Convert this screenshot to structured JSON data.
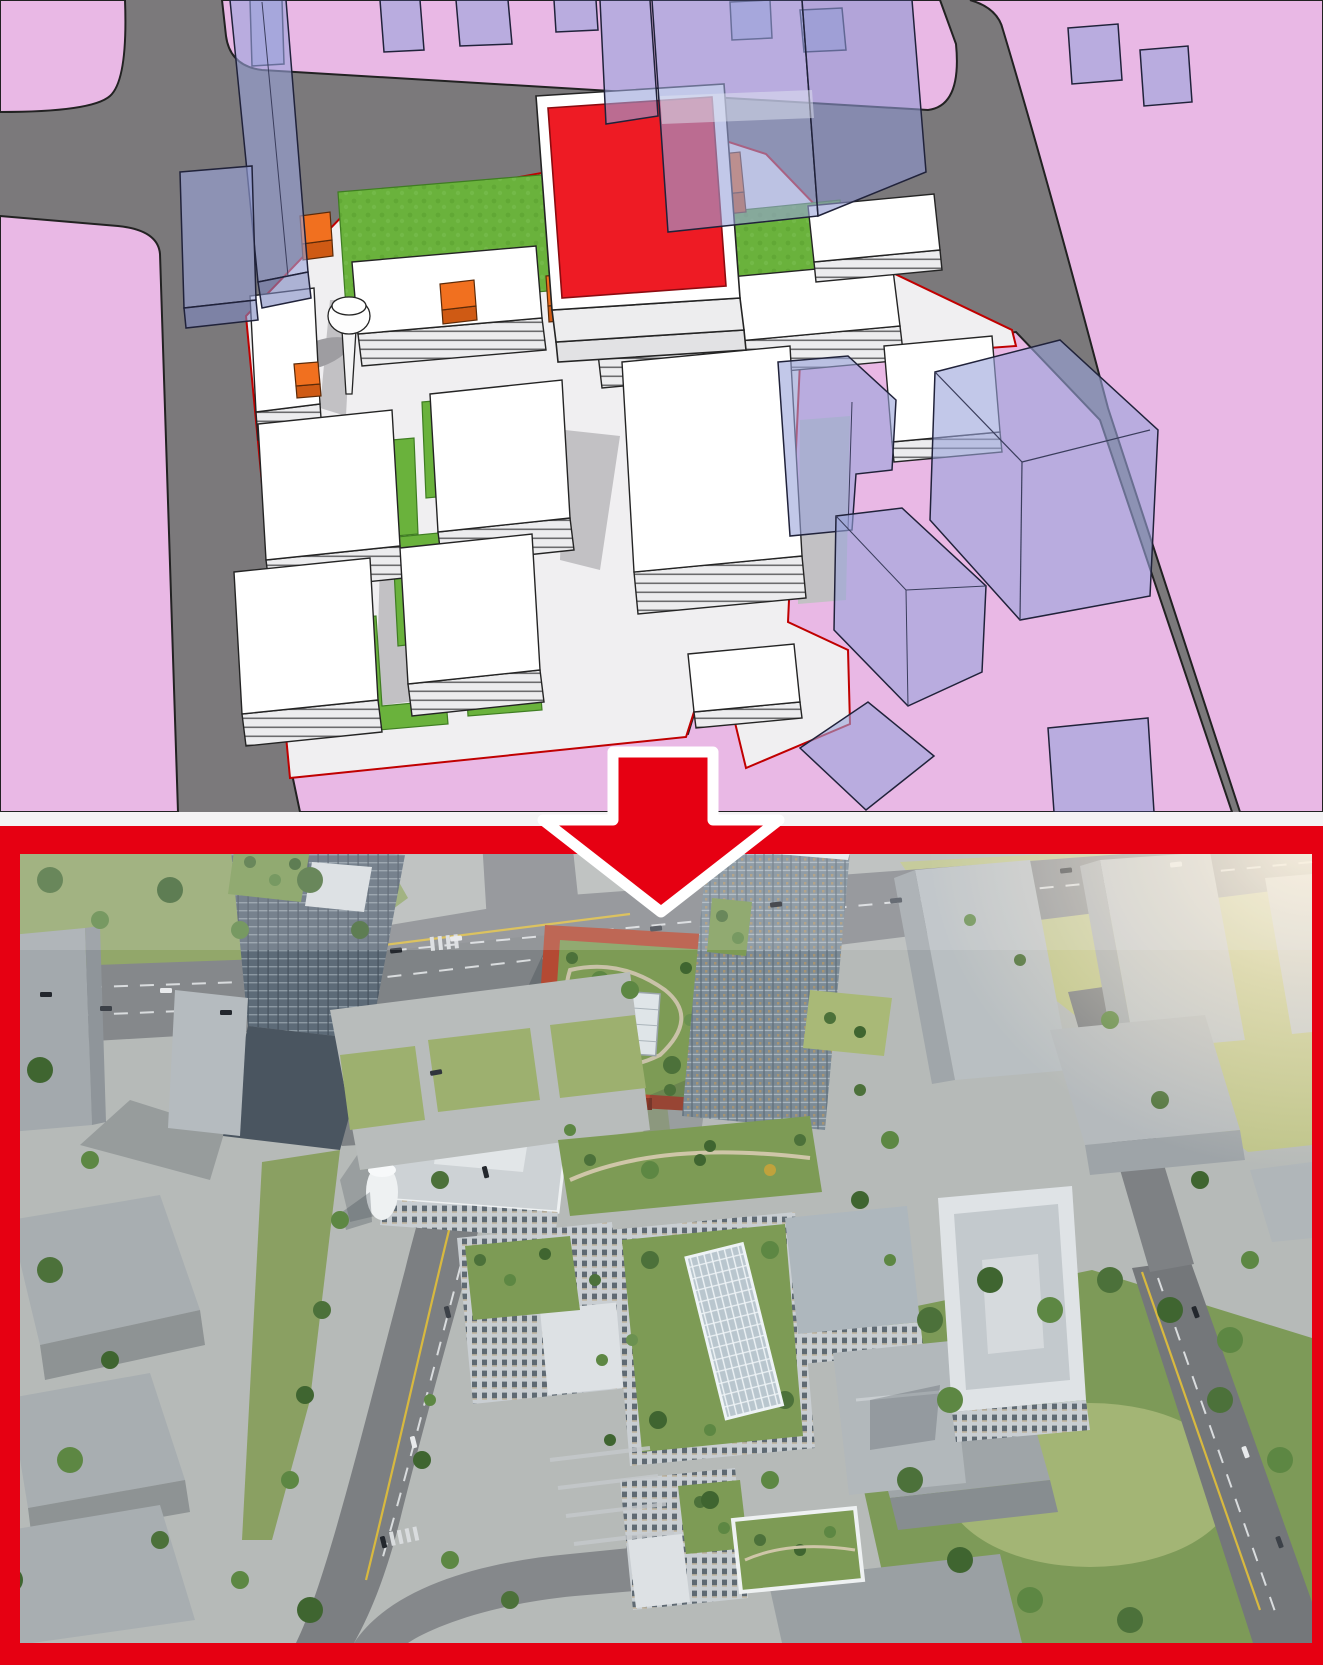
{
  "meta": {
    "description": "architectural before-after graphic: concept massing model above, photorealistic aerial render below, linked by a downward arrow",
    "top_scene_name": "concept-massing-model",
    "bottom_scene_name": "photoreal-aerial-render",
    "arrow_icon": "arrow-down-icon"
  },
  "palette": {
    "massing_pink": "#e9b8e5",
    "massing_road_gray": "#7b797b",
    "massing_site_white": "#f0eff1",
    "massing_building_white": "#ffffff",
    "massing_green": "#6ab23c",
    "massing_red": "#ee1b24",
    "massing_orange": "#f1701f",
    "massing_context_blue": "#9aa3da",
    "outline_dark": "#232323",
    "divider_white": "#f4f3f4",
    "frame_red": "#e60012",
    "arrow_red": "#e60012",
    "arrow_outline": "#ffffff",
    "render_ground": "#b6bab8",
    "render_road": "#85888b",
    "render_intersection": "#7f8386",
    "render_grass": "#92a76a",
    "render_park_green": "#7d9a58",
    "render_tree_green": "#4c713a",
    "render_red_building": "#b44a33",
    "render_roof_garden": "#7d9b55",
    "render_glass_facade": "#5d6b78",
    "render_white_roof": "#dde1e4",
    "render_context_gray": "#a8aeb1",
    "render_marking_yellow": "#d8b93f",
    "render_sun_glare": "#fff4dd"
  }
}
